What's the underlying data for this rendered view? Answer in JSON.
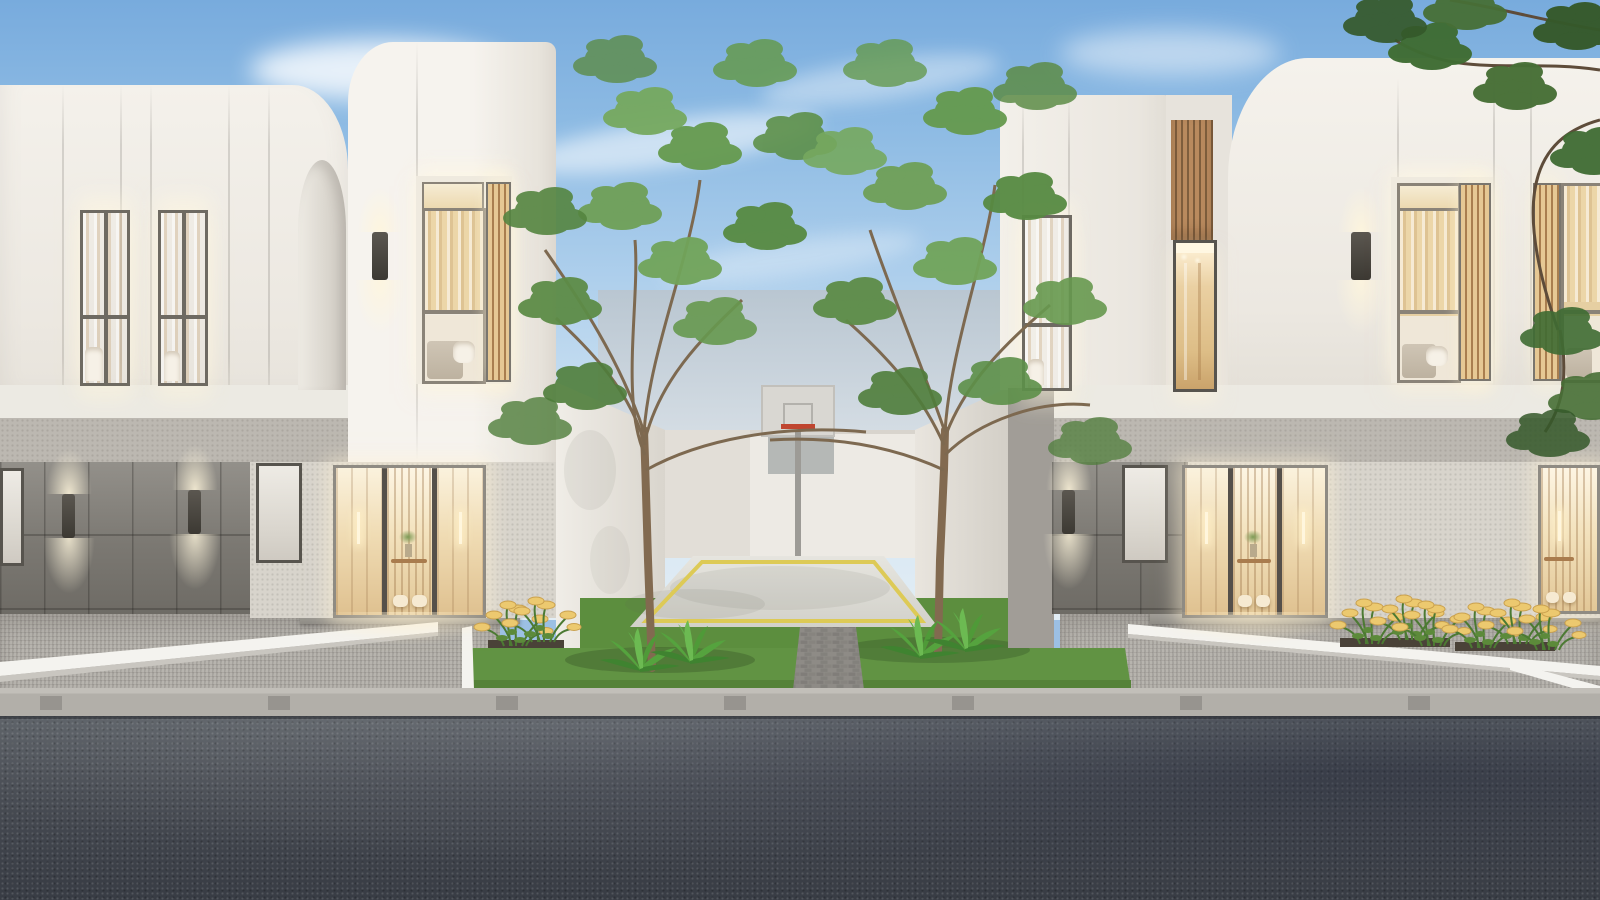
{
  "meta": {
    "title": "Modern minimalist townhouse complex — exterior render at dusk",
    "description": "Two-storey white render townhouses flanking a shared courtyard basketball court with two trees, warm-lit entry doors and bedroom windows, paver driveways, a grey paver sidewalk and an asphalt street in the foreground under a blue sky with wispy clouds."
  },
  "palette": {
    "sky_top": "#78abdd",
    "sky_horizon": "#e2edf5",
    "cloud": "#ffffff",
    "facade_white": "#f1eee8",
    "facade_shadow": "#ddd8d0",
    "stone_band": "#bcb8b1",
    "plank_wall": "#7b7872",
    "tile_wall": "#a19d97",
    "window_frame": "#6e6a62",
    "warm_interior": "#e9d2a4",
    "warm_glow": "#fff3d6",
    "wood_slat": "#b98a5e",
    "grass": "#5f9140",
    "fern_green": "#55a33e",
    "leaf_green": "#6fa057",
    "leaf_dark": "#3f6c33",
    "trunk": "#826a50",
    "court_floor": "#e0dfd8",
    "court_line_yellow": "#ddca56",
    "backboard": "#d9d7d2",
    "hoop_rim_red": "#c0452f",
    "walkway_paver": "#96948f",
    "sidewalk_paver": "#b2afa9",
    "curb_white": "#f4f3ef",
    "asphalt": "#43474e",
    "flower_yellow": "#ecc96f"
  },
  "scene": {
    "sky": {
      "clouds": 5
    },
    "left_building": {
      "upper_facade_windows": 2,
      "tower_bedroom_window": 1,
      "wall_sconces": 3,
      "entry_door": "warm-lit triple glass door with slat wall, console, plant and two poufs",
      "garage_plank_wall": true,
      "frosted_window": 1
    },
    "courtyard": {
      "trees": 2,
      "ferns": 4,
      "basketball_hoop": {
        "backboard": 1,
        "rim_color": "#c0452f",
        "pole": 1
      },
      "court_floor": "light concrete with yellow boundary line",
      "grass_lawn": true,
      "paver_walkway": true
    },
    "right_building": {
      "tower_window": 1,
      "wood_slat_band": 1,
      "hallway_window": 1,
      "bedroom_windows": 2,
      "wall_sconces": 2,
      "entry_doors": 2,
      "frosted_window": 1
    },
    "street": {
      "aprons": "grey paver driveways",
      "sidewalk": "light paver band with dark slots",
      "road": "dark speckled asphalt with tree shadow",
      "curbs_white": 4
    },
    "landscaping": {
      "flower_clusters": 3,
      "flower_color": "yellow daisies",
      "overhanging_tree": "dark green, top right"
    }
  }
}
